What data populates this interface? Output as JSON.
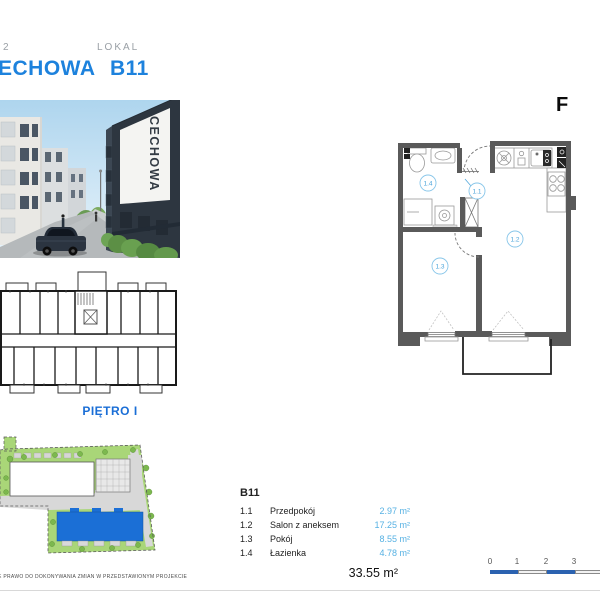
{
  "header": {
    "stage": "2",
    "name": "ECHOWA",
    "lokal_label": "LOKAL",
    "unit": "B11"
  },
  "logo": {
    "text": "F"
  },
  "photo": {
    "sign": "CECHOWA"
  },
  "building_plan": {
    "label": "PIĘTRO I"
  },
  "unit_plan": {
    "markers": {
      "m14": "1.4",
      "m11": "1.1",
      "m12": "1.2",
      "m13": "1.3"
    }
  },
  "legend": {
    "unit": "B11",
    "rows": [
      {
        "code": "1.1",
        "name": "Przedpokój",
        "area": "2.97 m²"
      },
      {
        "code": "1.2",
        "name": "Salon z aneksem",
        "area": "17.25 m²"
      },
      {
        "code": "1.3",
        "name": "Pokój",
        "area": "8.55 m²"
      },
      {
        "code": "1.4",
        "name": "Łazienka",
        "area": "4.78 m²"
      }
    ],
    "total": "33.55 m²"
  },
  "scalebar": {
    "ticks": [
      "0",
      "1",
      "2",
      "3"
    ]
  },
  "footer": {
    "disclaimer": "E PRAWO DO DOKONYWANIA ZMIAN W PRZEDSTAWIONYM PROJEKCIE"
  },
  "colors": {
    "accent": "#1d82dd",
    "area_text": "#56b1e3",
    "floor_label": "#1a6ed6",
    "site_building": "#1b6fd6",
    "scalebar_blue": "#2b62b0",
    "walls": "#5a5a5a"
  }
}
